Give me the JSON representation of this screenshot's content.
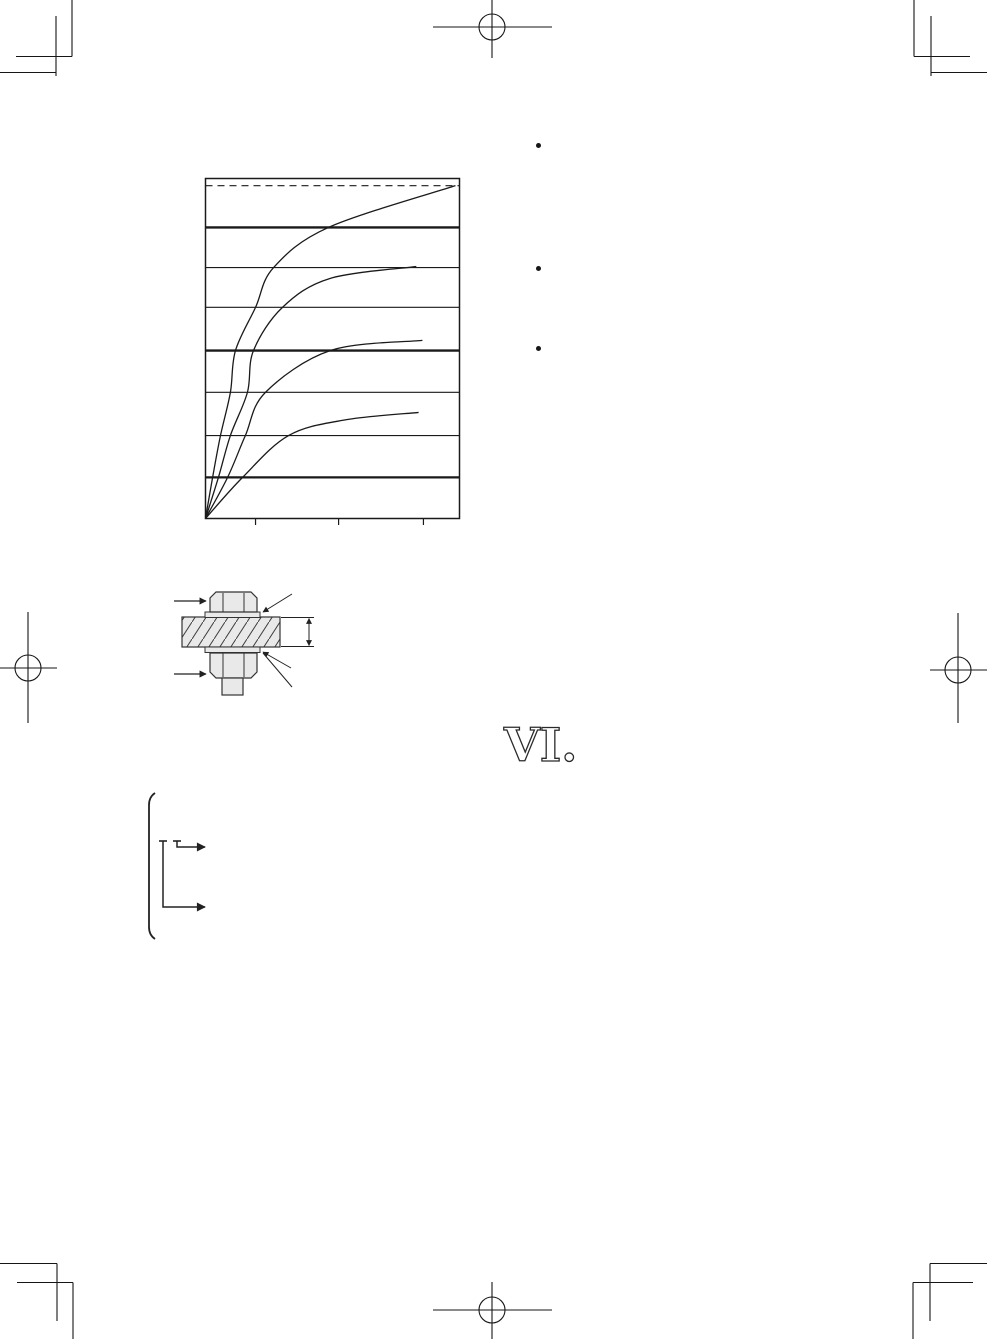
{
  "page": {
    "heading_numeral": "VI.",
    "background": "#ffffff",
    "ink_color": "#1a1a1a",
    "figure_line_color": "#333333",
    "metal_fill_color": "#e9e9e9"
  },
  "bullets": [
    {
      "icon": "bullet-icon"
    },
    {
      "icon": "bullet-icon"
    },
    {
      "icon": "bullet-icon"
    }
  ],
  "figures": {
    "chart": "tightening-curves-chart",
    "bolt": "bolt-nut-washer-cross-section",
    "bracket": "options-bracket-arrows"
  },
  "chart_data": {
    "type": "line",
    "title": "",
    "xlabel": "",
    "ylabel": "",
    "axis_ranges_labeled": false,
    "x_range_frac": [
      0,
      1
    ],
    "y_range_frac": [
      0,
      1
    ],
    "grid": "horizontal-only",
    "legend": "none",
    "x_ticks_frac": [
      0.197,
      0.524,
      0.858
    ],
    "dashed_top_line_frac": 0.979,
    "y_gridlines": [
      {
        "frac": 0.121,
        "weight": "thick"
      },
      {
        "frac": 0.244,
        "weight": "thin"
      },
      {
        "frac": 0.371,
        "weight": "thin"
      },
      {
        "frac": 0.494,
        "weight": "thick"
      },
      {
        "frac": 0.621,
        "weight": "thin"
      },
      {
        "frac": 0.738,
        "weight": "thin"
      },
      {
        "frac": 0.856,
        "weight": "thick"
      }
    ],
    "series": [
      {
        "name": "curve-1",
        "points": [
          [
            0,
            0
          ],
          [
            0.028,
            0.121
          ],
          [
            0.059,
            0.244
          ],
          [
            0.098,
            0.371
          ],
          [
            0.118,
            0.494
          ],
          [
            0.197,
            0.621
          ],
          [
            0.268,
            0.738
          ],
          [
            0.484,
            0.856
          ],
          [
            0.984,
            0.979
          ]
        ]
      },
      {
        "name": "curve-2",
        "points": [
          [
            0,
            0
          ],
          [
            0.051,
            0.121
          ],
          [
            0.098,
            0.244
          ],
          [
            0.165,
            0.371
          ],
          [
            0.189,
            0.494
          ],
          [
            0.303,
            0.621
          ],
          [
            0.49,
            0.706
          ],
          [
            0.83,
            0.741
          ]
        ]
      },
      {
        "name": "curve-3",
        "points": [
          [
            0,
            0
          ],
          [
            0.087,
            0.121
          ],
          [
            0.157,
            0.244
          ],
          [
            0.236,
            0.371
          ],
          [
            0.492,
            0.494
          ],
          [
            0.854,
            0.524
          ]
        ]
      },
      {
        "name": "curve-4",
        "points": [
          [
            0,
            0
          ],
          [
            0.146,
            0.121
          ],
          [
            0.327,
            0.244
          ],
          [
            0.55,
            0.29
          ],
          [
            0.839,
            0.312
          ]
        ]
      }
    ]
  }
}
